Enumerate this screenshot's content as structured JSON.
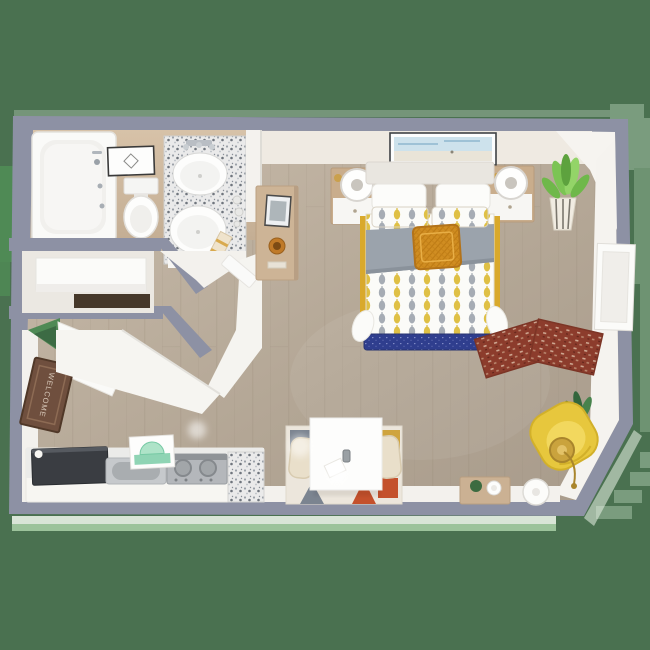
{
  "scene": {
    "type": "3d-floor-plan",
    "description": "Top-down 3D rendering of a studio apartment floor plan on a green background",
    "background_color": "#4a7150",
    "wall_color": "#8d91a4",
    "floor_color": "#b9ac9b"
  },
  "entry": {
    "mat_text": "WELCOME",
    "items": [
      "open-door",
      "welcome-mat"
    ]
  },
  "rooms": [
    {
      "name": "bathroom",
      "items": [
        "bathtub",
        "toilet",
        "double-sink-granite-vanity",
        "framed-wall-art",
        "towel-ladder"
      ]
    },
    {
      "name": "closet",
      "items": [
        "shelf"
      ]
    },
    {
      "name": "kitchen",
      "items": [
        "refrigerator",
        "stainless-sink",
        "cooktop-stove",
        "granite-counter",
        "mint-art-print"
      ]
    },
    {
      "name": "bedroom",
      "items": [
        "bed-with-patterned-duvet",
        "gray-throw-blanket",
        "mustard-throw-pillow",
        "nightstand-left",
        "nightstand-right",
        "globe-lamp-left",
        "globe-lamp-right",
        "beach-wall-art",
        "wood-console-table",
        "photo-frame",
        "orange-bowl",
        "potted-plant-striped-pot",
        "leaning-white-panel"
      ]
    },
    {
      "name": "living-area",
      "items": [
        "yellow-armchair",
        "gold-floor-lamp",
        "dark-plant",
        "rust-rug-left",
        "rust-rug-right",
        "wood-side-table",
        "round-white-table",
        "white-desk",
        "woven-chair-left",
        "woven-chair-right",
        "geometric-rug",
        "soda-can",
        "paper-sheet"
      ]
    }
  ],
  "palette": {
    "background_green": "#4a7150",
    "accent_light_green": "#7a9c7e",
    "accent_bright_green": "#4f8a55",
    "pale_green_edge": "#9cc39b",
    "wall_slate": "#8d91a4",
    "wall_face_white": "#f4f2ee",
    "wall_face_cream": "#efeae2",
    "floor_wood_light": "#c9bcab",
    "floor_wood_dark": "#a89b8b",
    "bath_floor_tan": "#d2bda3",
    "duvet_yellow": "#dfc045",
    "duvet_gray": "#a6acb4",
    "blanket_gray": "#9ba3ac",
    "pillow_mustard": "#d08d21",
    "bed_rail_gold": "#d9a92c",
    "bench_navy": "#2f3e8e",
    "armchair_yellow": "#e7c73d",
    "lamp_gold": "#caa33d",
    "rug_rust": "#8c3c2c",
    "fridge_charcoal": "#3a3d42",
    "mat_brown": "#6f4f3e",
    "mint": "#8fd4b4",
    "rug_orange": "#c4512c"
  }
}
